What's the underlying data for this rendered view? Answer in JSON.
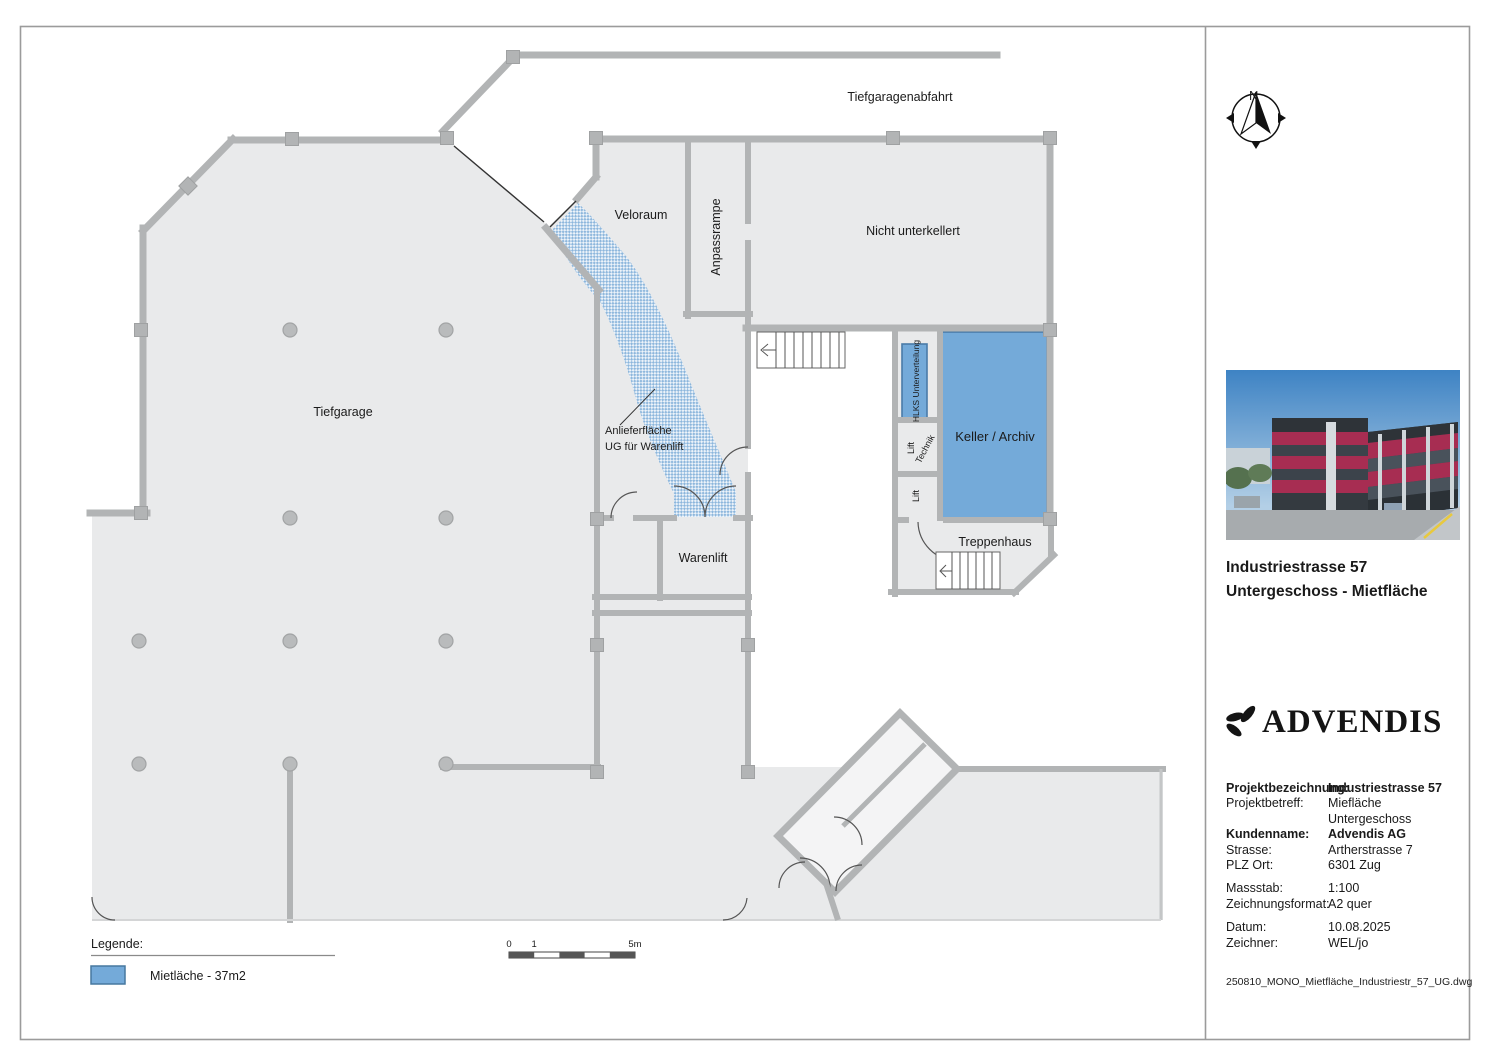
{
  "plan": {
    "labels": {
      "tiefgaragenabfahrt": "Tiefgaragenabfahrt",
      "veloraum": "Veloraum",
      "anpassrampe": "Anpassrampe",
      "nicht_unterkellert": "Nicht unterkellert",
      "tiefgarage": "Tiefgarage",
      "anlieferflaeche_line1": "Anlieferfläche",
      "anlieferflaeche_line2": "UG für Warenlift",
      "hlks": "HLKS Unterverteilung",
      "keller_archiv": "Keller / Archiv",
      "lift_upper": "Lift",
      "technik": "Technik",
      "lift_lower": "Lift",
      "treppenhaus": "Treppenhaus",
      "warenlift": "Warenlift"
    },
    "legend": {
      "title": "Legende:",
      "item_label": "Mietläche - 37m2"
    },
    "scalebar": {
      "zero": "0",
      "one": "1",
      "five": "5m"
    },
    "compass": {
      "north_label": "N"
    }
  },
  "panel": {
    "title_line1": "Industriestrasse 57",
    "title_line2": "Untergeschoss - Mietfläche",
    "logo_text": "ADVENDIS",
    "meta": [
      {
        "label": "Projektbezeichnung:",
        "value": "Industriestrasse 57"
      },
      {
        "label": "Projektbetreff:",
        "value": "Miefläche Untergeschoss"
      },
      {
        "label": "Kundenname:",
        "value": "Advendis AG"
      },
      {
        "label": "Strasse:",
        "value": "Artherstrasse 7"
      },
      {
        "label": "PLZ Ort:",
        "value": "6301 Zug"
      },
      {
        "label": "Massstab:",
        "value": "1:100"
      },
      {
        "label": "Zeichnungsformat:",
        "value": "A2 quer"
      },
      {
        "label": "Datum:",
        "value": "10.08.2025"
      },
      {
        "label": "Zeichner:",
        "value": "WEL/jo"
      }
    ],
    "filename": "250810_MONO_Mietfläche_Industriestr_57_UG.dwg"
  },
  "colors": {
    "mietflaeche": "#74aad9",
    "mietflaeche_border": "#4a7ba8",
    "wall": "#b2b4b5",
    "floor": "#e9eaeb",
    "facade": "#a72d52"
  }
}
